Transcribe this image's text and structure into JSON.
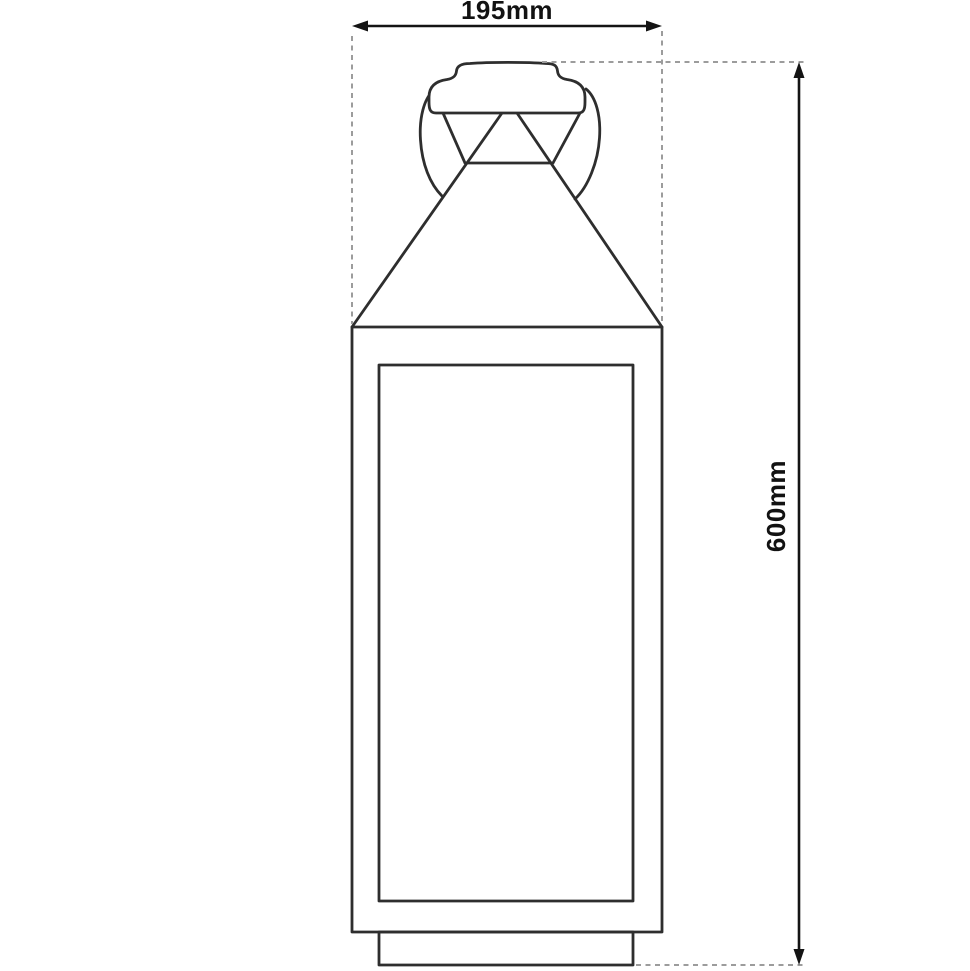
{
  "diagram": {
    "type": "technical-dimension-drawing",
    "subject": "lantern-front-elevation",
    "width_dimension": {
      "label": "195mm"
    },
    "height_dimension": {
      "label": "600mm"
    }
  },
  "colors": {
    "background": "#ffffff",
    "drawing_outline": "#2e2e2e",
    "dimension_line": "#141414",
    "extension_dash": "#9c9c9c",
    "label_text": "#121212"
  }
}
